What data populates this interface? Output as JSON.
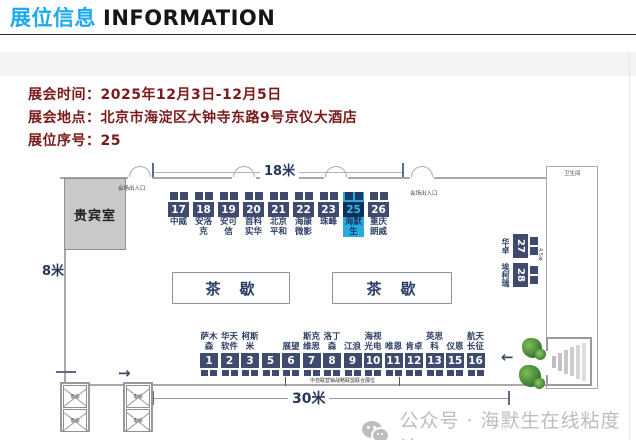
{
  "header": {
    "title_zh": "展位信息",
    "title_en": "INFORMATION"
  },
  "info": {
    "lines": [
      {
        "label": "展会时间：",
        "value": "2025年12月3日-12月5日"
      },
      {
        "label": "展会地点：",
        "value": "北京市海淀区大钟寺东路9号京仪大酒店"
      },
      {
        "label": "展位序号：",
        "value": "25"
      }
    ]
  },
  "floorplan": {
    "dim_top": "18米",
    "dim_left": "8米",
    "dim_bottom": "30米",
    "dim_right": "4.5米",
    "vip_room": "贵宾室",
    "restroom": "卫生间",
    "tea_break": "茶　歇",
    "entrance": "会场出入口",
    "elevator": "电梯",
    "alliance_note": "中自联营销战略联盟联合展位",
    "arrow_right_glyph": "→",
    "arrow_left_glyph": "←",
    "highlight_booth": "25",
    "colors": {
      "booth_navy": "#3e4a6e",
      "booth_label": "#2e3f66",
      "highlight_cyan": "#29abe2",
      "highlight_num_bg": "#0c3156",
      "title_accent": "#1ba9f1",
      "info_text": "#7a1a1a"
    },
    "top_booths": [
      {
        "num": "17",
        "label": "中威"
      },
      {
        "num": "18",
        "label": "安洛\n克"
      },
      {
        "num": "19",
        "label": "安可\n信"
      },
      {
        "num": "20",
        "label": "首科\n实华"
      },
      {
        "num": "21",
        "label": "北京\n平和"
      },
      {
        "num": "22",
        "label": "海康\n微影"
      },
      {
        "num": "23",
        "label": "珠峰"
      },
      {
        "num": "25",
        "label": "海默\n生",
        "highlight": true
      },
      {
        "num": "26",
        "label": "重庆\n朗威"
      }
    ],
    "bottom_booths": [
      {
        "num": "1",
        "label": "萨木\n森"
      },
      {
        "num": "2",
        "label": "华天\n软件"
      },
      {
        "num": "3",
        "label": "柯斯\n米"
      },
      {
        "num": "5",
        "label": ""
      },
      {
        "num": "6",
        "label": "展望"
      },
      {
        "num": "7",
        "label": "斯克\n维思"
      },
      {
        "num": "8",
        "label": "洛丁\n森"
      },
      {
        "num": "9",
        "label": "江浪"
      },
      {
        "num": "10",
        "label": "海视\n光电"
      },
      {
        "num": "11",
        "label": "唯恩"
      },
      {
        "num": "12",
        "label": "肯卓"
      },
      {
        "num": "13",
        "label": "英思\n科"
      },
      {
        "num": "15",
        "label": "仪恩"
      },
      {
        "num": "16",
        "label": "航天\n长征"
      }
    ],
    "side_booths": [
      {
        "num": "27",
        "label": "华卓"
      },
      {
        "num": "28",
        "label": "埃柯瑞"
      }
    ]
  },
  "watermark": {
    "text": "公众号 · 海默生在线粘度计"
  }
}
